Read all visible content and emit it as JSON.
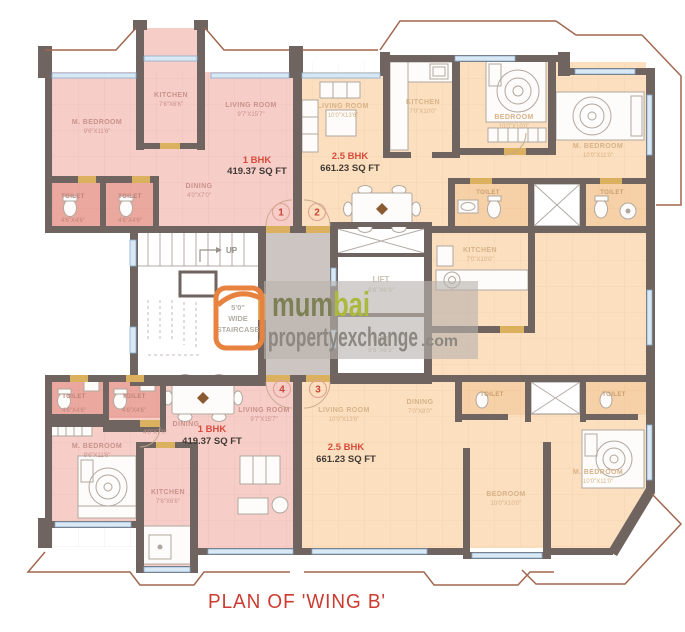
{
  "title": "PLAN OF 'WING B'",
  "watermark": {
    "brand_mum": "mum",
    "brand_bai": "bai",
    "brand_line2": "propertyexchange",
    "brand_suffix": ".com"
  },
  "core": {
    "up": "UP",
    "stair_l1": "5'0\"",
    "stair_l2": "WIDE",
    "stair_l3": "STAIRCASE",
    "lift1": {
      "name": "LIFT",
      "dim": "8'6\"X6'3\""
    },
    "lift2": {
      "name": "LIFT",
      "dim": "8'6\"X6'3\""
    }
  },
  "flats": {
    "f1": {
      "number": "1",
      "type": "1 BHK",
      "area": "419.37 SQ FT",
      "rooms": {
        "m_bedroom": {
          "name": "M. BEDROOM",
          "dim": "9'6\"X11'6\""
        },
        "kitchen": {
          "name": "KITCHEN",
          "dim": "7'6\"X6'6\""
        },
        "living": {
          "name": "LIVING ROOM",
          "dim": "9'7\"X15'7\""
        },
        "dining": {
          "name": "DINING",
          "dim": "4'0\"X7'0\""
        },
        "toilet1": {
          "name": "TOILET",
          "dim": "4'6\"X4'6\""
        },
        "toilet2": {
          "name": "TOILET",
          "dim": "4'6\"X4'6\""
        }
      }
    },
    "f2": {
      "number": "2",
      "type": "2.5 BHK",
      "area": "661.23 SQ FT",
      "rooms": {
        "living": {
          "name": "LIVING ROOM",
          "dim": "10'0\"X13'6\""
        },
        "kitchen": {
          "name": "KITCHEN",
          "dim": "7'0\"X10'0\""
        },
        "bedroom": {
          "name": "BEDROOM",
          "dim": "10'0\"X10'0\""
        },
        "m_bedroom": {
          "name": "M. BEDROOM",
          "dim": "10'0\"X11'0\""
        },
        "toilet1": {
          "name": "TOILET",
          "dim": "4'6\"X7'0\""
        },
        "toilet2": {
          "name": "TOILET",
          "dim": "4'6\"X7'0\""
        }
      }
    },
    "f3": {
      "number": "3",
      "type": "2.5 BHK",
      "area": "661.23 SQ FT",
      "rooms": {
        "living": {
          "name": "LIVING ROOM",
          "dim": "10'0\"X13'6\""
        },
        "dining": {
          "name": "DINING",
          "dim": "7'0\"X8'0\""
        },
        "kitchen": {
          "name": "KITCHEN",
          "dim": "7'0\"X10'0\""
        },
        "bedroom": {
          "name": "BEDROOM",
          "dim": "10'0\"X10'0\""
        },
        "m_bedroom": {
          "name": "M. BEDROOM",
          "dim": "10'0\"X11'0\""
        },
        "toilet1": {
          "name": "TOILET",
          "dim": "4'6\"X7'0\""
        },
        "toilet2": {
          "name": "TOILET",
          "dim": "4'6\"X7'0\""
        }
      }
    },
    "f4": {
      "number": "4",
      "type": "1 BHK",
      "area": "419.37 SQ FT",
      "rooms": {
        "m_bedroom": {
          "name": "M. BEDROOM",
          "dim": "9'6\"X11'6\""
        },
        "kitchen": {
          "name": "KITCHEN",
          "dim": "7'6\"X6'6\""
        },
        "living": {
          "name": "LIVING ROOM",
          "dim": "9'7\"X15'7\""
        },
        "dining": {
          "name": "DINING",
          "dim": "4'0\"X7'0\""
        },
        "toilet1": {
          "name": "TOILET",
          "dim": "4'6\"X4'6\""
        },
        "toilet2": {
          "name": "TOILET",
          "dim": "4'6\"X4'6\""
        }
      }
    }
  },
  "colors": {
    "unit_pink": "#f7cdc8",
    "unit_pink_dark": "#eba89e",
    "unit_peach": "#fbdfbf",
    "wall": "#6f6460",
    "brand_orange": "#e8823f",
    "brand_green_dark": "#7d8055",
    "brand_green_light": "#abb93f",
    "brand_gray": "#8d8781",
    "title_red": "#cc3b2f"
  }
}
